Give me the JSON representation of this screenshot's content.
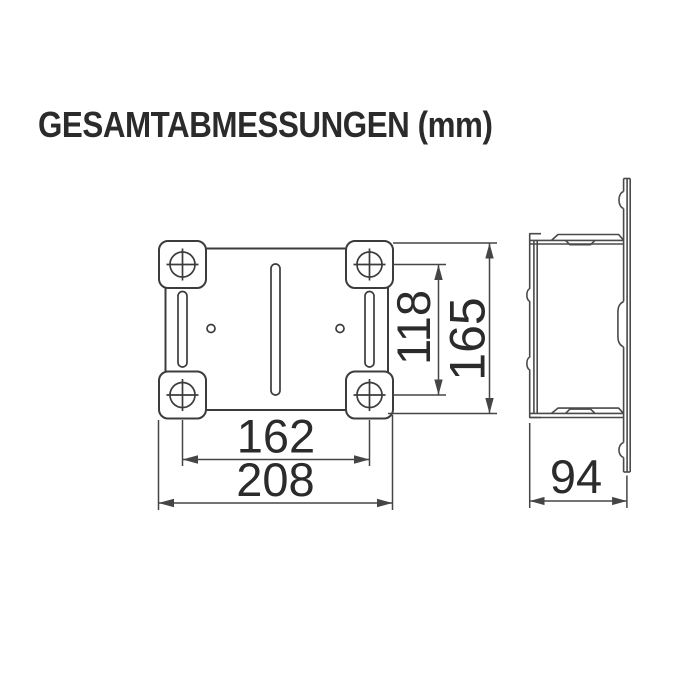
{
  "title": "GESAMTABMESSUNGEN (mm)",
  "colors": {
    "background": "#ffffff",
    "front_line": "#3c3c3c",
    "side_line": "#4a4a4a",
    "dimension_line": "#454545",
    "text": "#2b2b2b"
  },
  "front_view": {
    "dims": {
      "hole_spacing_x": "162",
      "overall_width": "208",
      "hole_spacing_y": "118",
      "overall_height": "165"
    }
  },
  "side_view": {
    "dims": {
      "depth": "94"
    }
  }
}
